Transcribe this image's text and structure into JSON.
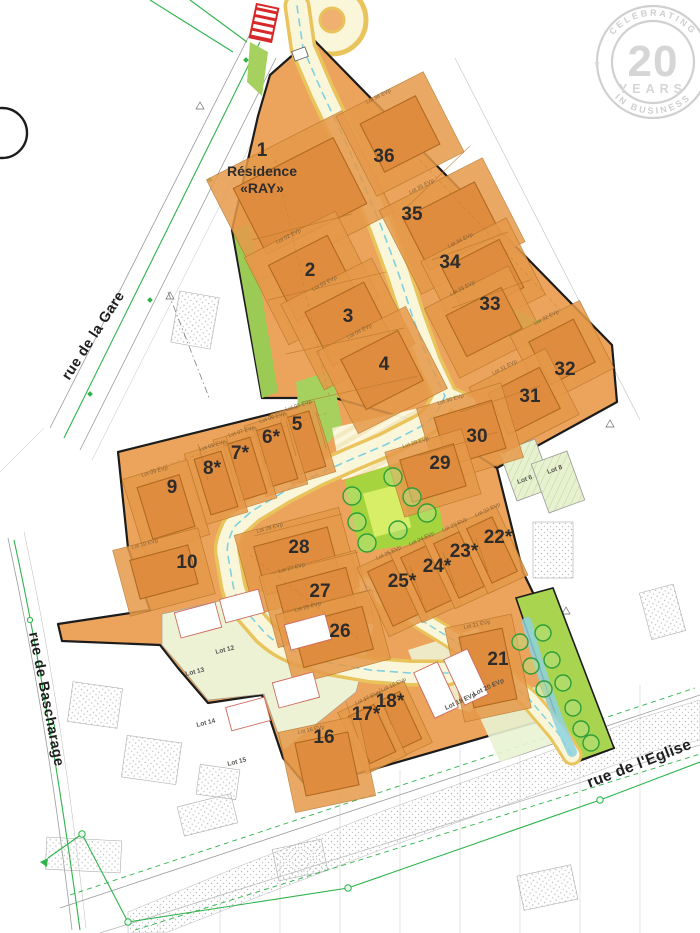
{
  "plan": {
    "residence": {
      "num": "1",
      "name_line1": "Résidence",
      "name_line2": "«RAY»",
      "x": 262,
      "y": 152
    },
    "streets": [
      {
        "name": "rue de la Gare",
        "x": 97,
        "y": 338,
        "rot": -57
      },
      {
        "name": "rue de Bascharage",
        "x": 42,
        "y": 700,
        "rot": 79
      },
      {
        "name": "rue de l'Eglise",
        "x": 641,
        "y": 768,
        "rot": -21
      }
    ],
    "micro_label_format": "Lot {n} EVp",
    "lots": [
      {
        "n": "2",
        "star": false,
        "lx": 310,
        "ly": 270,
        "fp": [
          312,
          278,
          66,
          62,
          -27
        ],
        "m": 18
      },
      {
        "n": "3",
        "star": false,
        "lx": 348,
        "ly": 316,
        "fp": [
          348,
          324,
          66,
          60,
          -27
        ],
        "m": 18
      },
      {
        "n": "4",
        "star": false,
        "lx": 384,
        "ly": 364,
        "fp": [
          382,
          370,
          64,
          56,
          -27
        ],
        "m": 18
      },
      {
        "n": "36",
        "star": false,
        "lx": 384,
        "ly": 156,
        "fp": [
          400,
          134,
          62,
          54,
          -27
        ],
        "m": 18
      },
      {
        "n": "35",
        "star": false,
        "lx": 412,
        "ly": 214,
        "fp": [
          452,
          226,
          80,
          58,
          -27
        ],
        "m": 18
      },
      {
        "n": "34",
        "star": false,
        "lx": 450,
        "ly": 262,
        "fp": [
          483,
          278,
          64,
          54,
          -27
        ],
        "m": 16
      },
      {
        "n": "33",
        "star": false,
        "lx": 490,
        "ly": 304,
        "fp": [
          484,
          322,
          62,
          46,
          -27
        ],
        "m": 16
      },
      {
        "n": "32",
        "star": false,
        "lx": 565,
        "ly": 369,
        "fp": [
          562,
          352,
          50,
          48,
          -27
        ],
        "m": 14
      },
      {
        "n": "31",
        "star": false,
        "lx": 530,
        "ly": 396,
        "fp": [
          524,
          401,
          58,
          46,
          -27
        ],
        "m": 14
      },
      {
        "n": "30",
        "star": false,
        "lx": 477,
        "ly": 436,
        "fp": [
          470,
          433,
          60,
          50,
          -17
        ],
        "m": 14
      },
      {
        "n": "29",
        "star": false,
        "lx": 440,
        "ly": 463,
        "fp": [
          433,
          473,
          56,
          44,
          -17
        ],
        "m": 12
      },
      {
        "n": "5",
        "star": false,
        "lx": 297,
        "ly": 424,
        "fp": [
          303,
          443,
          30,
          58,
          -17
        ],
        "m": 8
      },
      {
        "n": "6",
        "star": true,
        "lx": 271,
        "ly": 437,
        "fp": [
          276,
          455,
          28,
          58,
          -17
        ],
        "m": 8
      },
      {
        "n": "7",
        "star": true,
        "lx": 240,
        "ly": 453,
        "fp": [
          245,
          469,
          28,
          58,
          -17
        ],
        "m": 8
      },
      {
        "n": "8",
        "star": true,
        "lx": 212,
        "ly": 468,
        "fp": [
          216,
          483,
          28,
          58,
          -17
        ],
        "m": 8
      },
      {
        "n": "9",
        "star": false,
        "lx": 172,
        "ly": 487,
        "fp": [
          166,
          507,
          44,
          54,
          -17
        ],
        "m": 12
      },
      {
        "n": "10",
        "star": false,
        "lx": 187,
        "ly": 562,
        "fp": [
          164,
          572,
          60,
          40,
          -15
        ],
        "m": 14
      },
      {
        "n": "28",
        "star": false,
        "lx": 299,
        "ly": 547,
        "fp": [
          297,
          561,
          76,
          50,
          -15
        ],
        "m": 16
      },
      {
        "n": "27",
        "star": false,
        "lx": 320,
        "ly": 591,
        "fp": [
          317,
          599,
          72,
          46,
          -15
        ],
        "m": 14
      },
      {
        "n": "26",
        "star": false,
        "lx": 340,
        "ly": 631,
        "fp": [
          333,
          637,
          72,
          44,
          -15
        ],
        "m": 14
      },
      {
        "n": "25",
        "star": true,
        "lx": 402,
        "ly": 581,
        "fp": [
          393,
          593,
          28,
          60,
          -25
        ],
        "m": 8
      },
      {
        "n": "24",
        "star": true,
        "lx": 437,
        "ly": 566,
        "fp": [
          426,
          579,
          28,
          60,
          -25
        ],
        "m": 8
      },
      {
        "n": "23",
        "star": true,
        "lx": 464,
        "ly": 551,
        "fp": [
          459,
          565,
          28,
          60,
          -25
        ],
        "m": 8
      },
      {
        "n": "22",
        "star": true,
        "lx": 498,
        "ly": 537,
        "fp": [
          492,
          550,
          28,
          60,
          -25
        ],
        "m": 8
      },
      {
        "n": "21",
        "star": false,
        "lx": 498,
        "ly": 659,
        "fp": [
          488,
          668,
          44,
          72,
          -12
        ],
        "m": 12
      },
      {
        "n": "18",
        "star": true,
        "lx": 390,
        "ly": 701,
        "fp": [
          398,
          721,
          28,
          52,
          -25
        ],
        "m": 8
      },
      {
        "n": "17",
        "star": true,
        "lx": 366,
        "ly": 714,
        "fp": [
          372,
          734,
          28,
          52,
          -25
        ],
        "m": 8
      },
      {
        "n": "16",
        "star": false,
        "lx": 324,
        "ly": 737,
        "fp": [
          327,
          764,
          54,
          54,
          -12
        ],
        "m": 14
      }
    ],
    "lot1_fp": [
      300,
      196,
      112,
      74,
      -27
    ],
    "small_lots": [
      {
        "label": "Lot 12",
        "x": 216,
        "y": 654,
        "rot": -14
      },
      {
        "label": "Lot 13",
        "x": 186,
        "y": 676,
        "rot": -14
      },
      {
        "label": "Lot 14",
        "x": 197,
        "y": 727,
        "rot": -14
      },
      {
        "label": "Lot 15",
        "x": 228,
        "y": 766,
        "rot": -14
      },
      {
        "label": "Lot 19 EVp",
        "x": 446,
        "y": 710,
        "rot": -25
      },
      {
        "label": "Lot 20 EVp",
        "x": 474,
        "y": 696,
        "rot": -25
      },
      {
        "label": "Lot 6",
        "x": 518,
        "y": 484,
        "rot": -20
      },
      {
        "label": "Lot 8",
        "x": 548,
        "y": 474,
        "rot": -20
      }
    ],
    "trees_strip": [
      [
        520,
        642
      ],
      [
        543,
        633
      ],
      [
        531,
        666
      ],
      [
        552,
        660
      ],
      [
        544,
        689
      ],
      [
        563,
        683
      ],
      [
        573,
        708
      ],
      [
        581,
        729
      ],
      [
        591,
        743
      ]
    ],
    "trees_park": [
      [
        352,
        496
      ],
      [
        357,
        522
      ],
      [
        367,
        543
      ],
      [
        393,
        477
      ],
      [
        412,
        497
      ],
      [
        427,
        513
      ],
      [
        398,
        530
      ]
    ],
    "white_houses": [
      [
        198,
        620,
        42,
        26,
        -15
      ],
      [
        242,
        606,
        40,
        24,
        -15
      ],
      [
        308,
        632,
        42,
        26,
        -15
      ],
      [
        296,
        690,
        42,
        26,
        -15
      ],
      [
        248,
        714,
        40,
        24,
        -15
      ],
      [
        436,
        690,
        26,
        50,
        -25
      ],
      [
        466,
        677,
        26,
        50,
        -25
      ]
    ]
  },
  "watermark": {
    "arc_top": "CELEBRATING",
    "number": "20",
    "mid": "YEARS",
    "arc_bottom": "IN BUSINESS",
    "star_left": "★",
    "star_right": "★"
  },
  "colors": {
    "orange_base": "#eca35b",
    "orange_ground": "#e6994a",
    "footprint": "#e08c3e",
    "footprint_stroke": "#b06a20",
    "road_fill": "#faf6da",
    "road_edge": "#e9c45d",
    "road_dash": "#7fd0e0",
    "green_strip": "#a2cf58",
    "park": "#a5d43e",
    "park_inner": "#d8ee66",
    "pale_lots": "#eef2d4",
    "pale_green": "#e7f1cf",
    "swale": "#8ed2de",
    "tree_stroke": "#2f9e3a",
    "tree_fill": "#b9e182",
    "boundary": "#1c1c1c",
    "gray_line": "#9b9b9b",
    "green_line": "#2eb34c",
    "red_marker": "#d7282a",
    "number": "#2d2c2b",
    "watermark": "#d2d2d2",
    "parcel_line": "#b5762a",
    "house_stroke": "#cc6a5e"
  }
}
